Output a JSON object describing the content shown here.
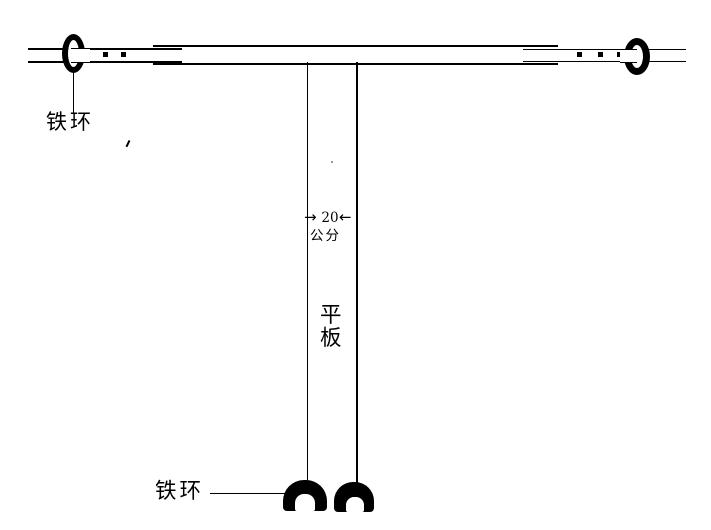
{
  "canvas": {
    "background_color": "#ffffff",
    "ink_color": "#000000"
  },
  "labels": {
    "top_iron_ring": "铁环",
    "bottom_iron_ring": "铁环",
    "plate_top_char": "平",
    "plate_bottom_char": "板"
  },
  "dimension": {
    "value": "20",
    "unit": "公分",
    "arrow_pointing_right": "→",
    "arrow_pointing_left": "←"
  }
}
